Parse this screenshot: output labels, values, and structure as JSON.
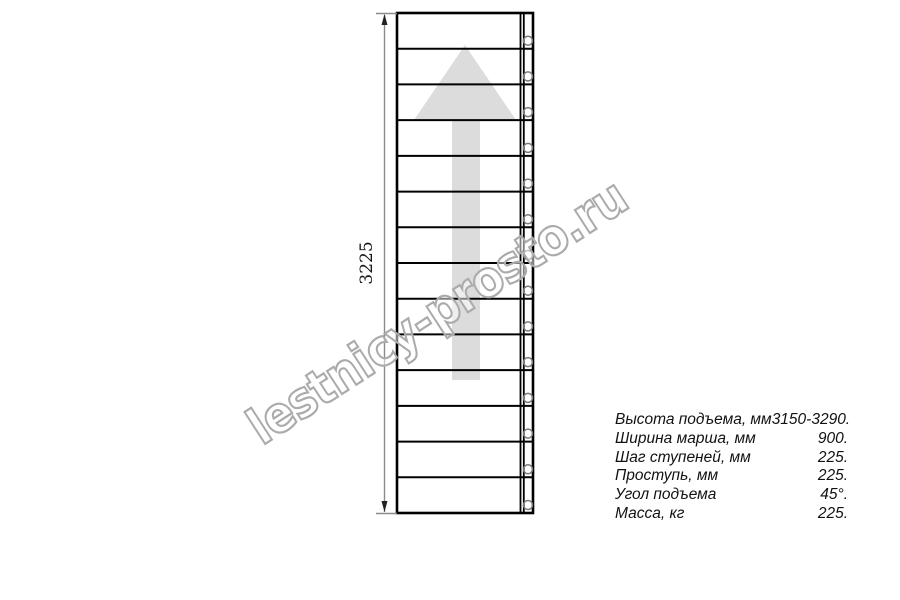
{
  "drawing": {
    "dimension_label": "3225",
    "steps_count": 14,
    "watermark_text": "lestnicy-prosto.ru"
  },
  "specs": {
    "rows": [
      {
        "label": "Высота подъема, мм",
        "value": "3150-3290."
      },
      {
        "label": "Ширина марша, мм",
        "value": "900."
      },
      {
        "label": "Шаг ступеней, мм",
        "value": "225."
      },
      {
        "label": "Проступь, мм",
        "value": "225."
      },
      {
        "label": "Угол подъема",
        "value": "45°."
      },
      {
        "label": "Масса, кг",
        "value": "225."
      }
    ]
  },
  "colors": {
    "line": "#000000",
    "arrow_fill": "#dcdcdc",
    "dimension": "#8a8a8a",
    "dimension_arrow": "#222222",
    "hole_outline": "#7a7a7a",
    "watermark_outline": "#ababab"
  }
}
